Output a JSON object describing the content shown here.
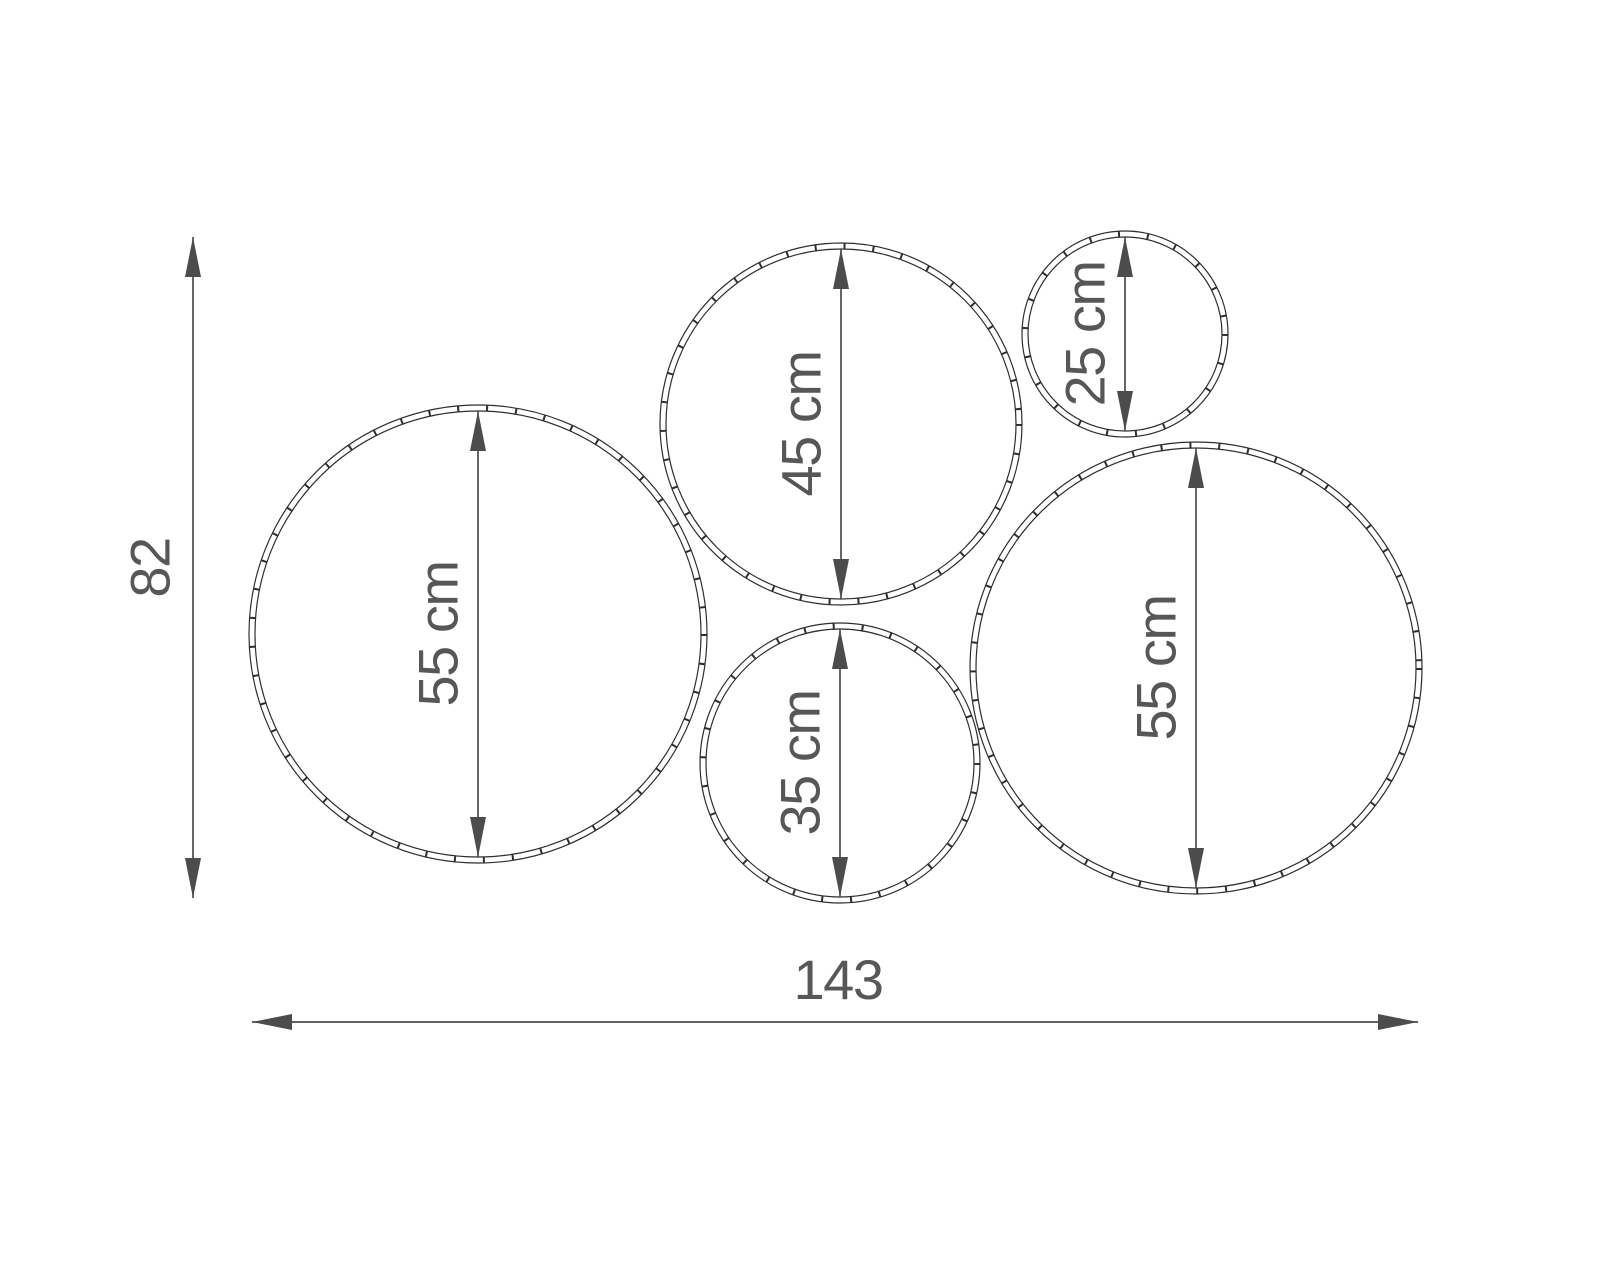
{
  "drawing": {
    "colors": {
      "background": "#ffffff",
      "ring_outline": "#2e2e2e",
      "dimension": "#4c4c4c",
      "label_text": "#575757"
    },
    "circles": [
      {
        "name": "circle-55-left",
        "label": "55 cm",
        "diameter_cm": 55,
        "cx": 478,
        "cy": 634,
        "r": 229
      },
      {
        "name": "circle-45-top",
        "label": "45 cm",
        "diameter_cm": 45,
        "cx": 841,
        "cy": 424,
        "r": 181
      },
      {
        "name": "circle-25-small",
        "label": "25 cm",
        "diameter_cm": 25,
        "cx": 1125,
        "cy": 334,
        "r": 103
      },
      {
        "name": "circle-35-bottom",
        "label": "35 cm",
        "diameter_cm": 35,
        "cx": 840,
        "cy": 763,
        "r": 140
      },
      {
        "name": "circle-55-right",
        "label": "55 cm",
        "diameter_cm": 55,
        "cx": 1196,
        "cy": 668,
        "r": 226
      }
    ],
    "height_dim": {
      "label": "82",
      "x": 193,
      "y1": 237,
      "y2": 898,
      "label_x": 150,
      "label_y": 568
    },
    "width_dim": {
      "label": "143",
      "y": 1022,
      "x1": 252,
      "x2": 1418,
      "label_x": 838,
      "label_y": 999
    },
    "arrow": {
      "length": 40,
      "half_width": 8,
      "ring_inset": 6
    }
  }
}
